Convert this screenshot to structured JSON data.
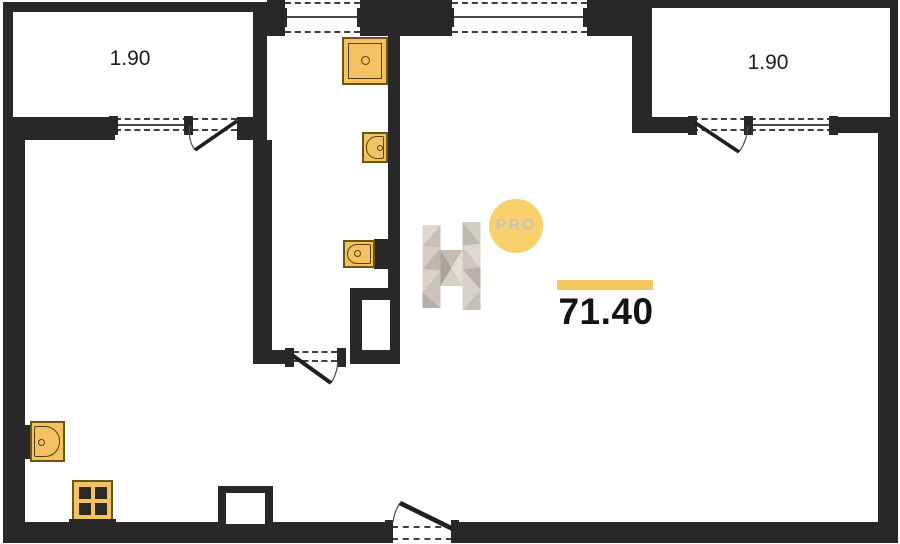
{
  "plan": {
    "balconies": [
      {
        "label": "1.90"
      },
      {
        "label": "1.90"
      }
    ],
    "area": {
      "value": "71.40"
    },
    "watermark": {
      "letter": "H",
      "badge": "PRO"
    },
    "fixtures": [
      {
        "name": "shower-tray"
      },
      {
        "name": "washbasin"
      },
      {
        "name": "toilet"
      },
      {
        "name": "washbasin"
      },
      {
        "name": "stove"
      }
    ],
    "colors": {
      "wall": "#282828",
      "fixture_fill": "#f3c263",
      "fixture_border": "#6d5512",
      "accent_yellow": "#f6c65f",
      "badge_yellow": "#f8d06c",
      "watermark_gray": "#cdc7bd"
    }
  }
}
